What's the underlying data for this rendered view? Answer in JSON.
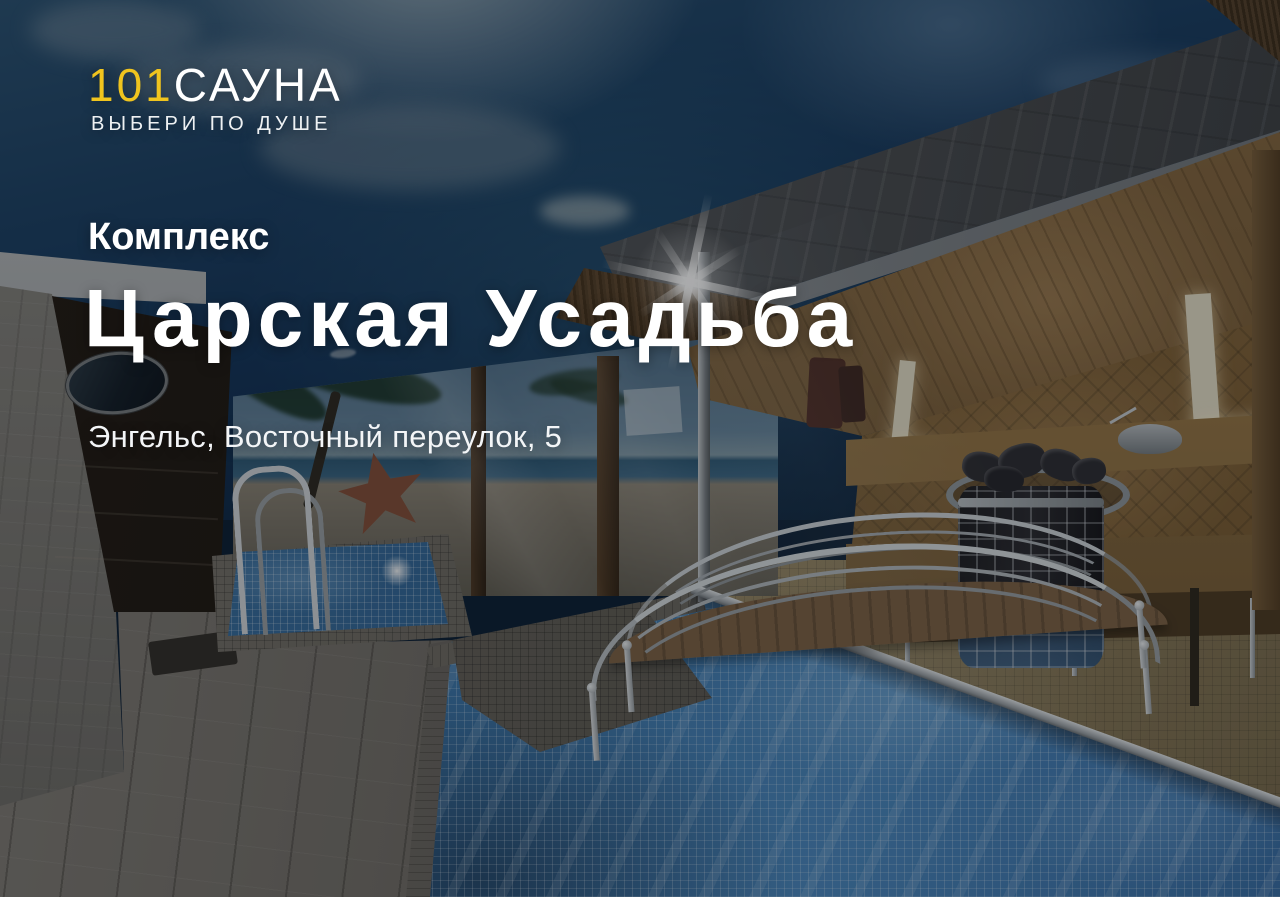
{
  "banner": {
    "brand": {
      "logo_number": "101",
      "logo_word": "САУНА",
      "tagline": "ВЫБЕРИ ПО ДУШЕ",
      "accent_color": "#F0C41E"
    },
    "category_label": "Комплекс",
    "title": "Царская Усадьба",
    "address": "Энгельс, Восточный переулок, 5"
  },
  "photo_palette": {
    "sky_blue": "#16395C",
    "pool_blue": "#3F77AC",
    "wood_tan": "#8A6B44",
    "marble_grey": "#7E7C78",
    "stone_grey": "#55585B",
    "mural_sea": "#35607C",
    "overlay": "rgba(7,9,13,0.34)"
  }
}
